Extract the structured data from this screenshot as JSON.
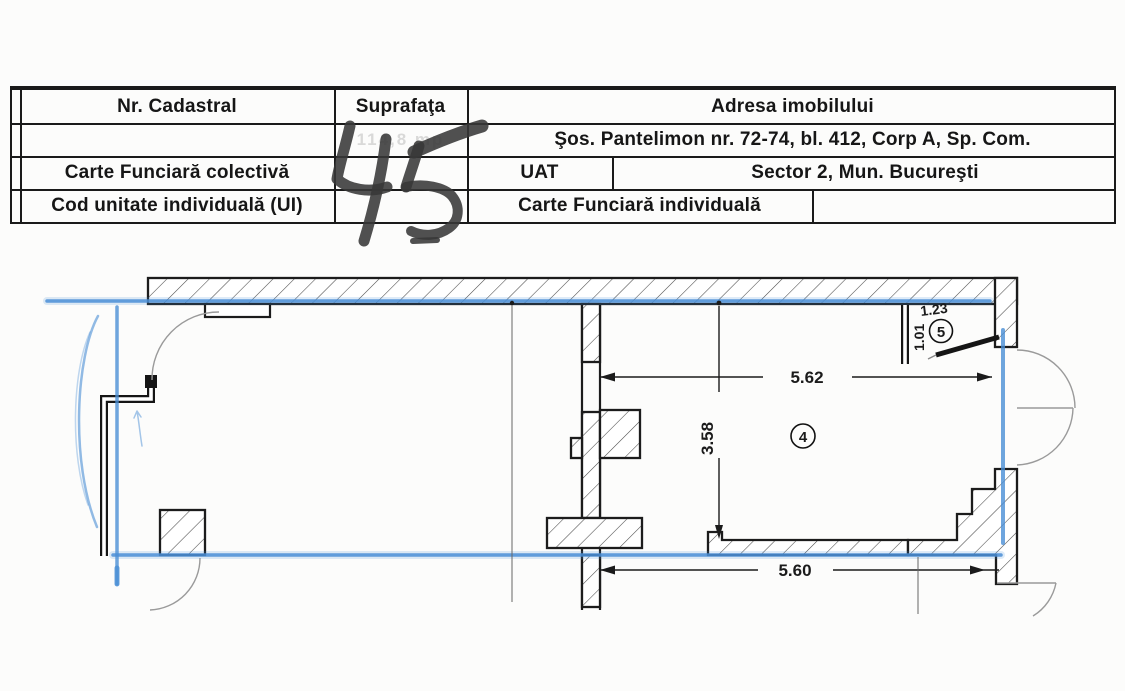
{
  "document": {
    "table": {
      "header": {
        "nr_cadastral": "Nr. Cadastral",
        "suprafata": "Suprafaţa",
        "adresa": "Adresa imobilului"
      },
      "rows": {
        "cadastral_value": "",
        "suprafata_value": "114,8 mp",
        "address": "Şos. Pantelimon nr. 72-74, bl. 412, Corp A, Sp. Com.",
        "cf_colectiva_label": "Carte Funciară colectivă",
        "uat_label": "UAT",
        "uat_value": "Sector 2, Mun. Bucureşti",
        "cod_ui_label": "Cod unitate individuală (UI)",
        "cf_individuala_label": "Carte Funciară individuală",
        "cf_individuala_value": ""
      }
    },
    "handwritten_number": "45",
    "plan": {
      "dimensions": {
        "width_top": "5.62",
        "height_mid": "3.58",
        "width_bottom": "5.60",
        "room5_width": "1.23",
        "room5_height": "1.01"
      },
      "rooms": {
        "room4": "4",
        "room5": "5"
      }
    },
    "colors": {
      "boundary_blue": "#4a8ed6",
      "wall_black": "#1c1c1c",
      "door_gray": "#9a9a9a",
      "marker_gray": "#383838"
    }
  }
}
